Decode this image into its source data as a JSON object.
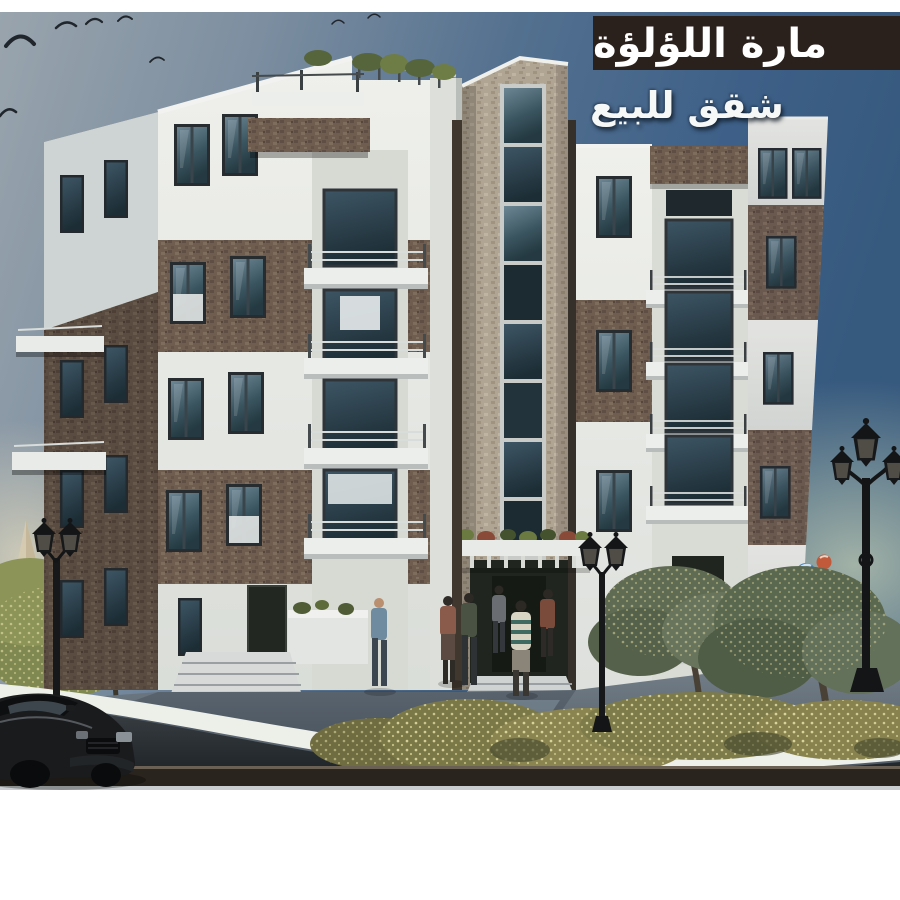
{
  "banner": {
    "title": "مارة اللؤلؤة",
    "bg": "#2b211c",
    "text_color": "#ffffff"
  },
  "caption": {
    "text": "شقق للبيع",
    "text_color": "#f6f8f8"
  },
  "colors": {
    "page_margin": "#ffffff",
    "sky_left": "#99a4ad",
    "sky_right": "#36597e",
    "sky_horizon_glow": "#b5c2ae",
    "building_plaster": "#eff0ec",
    "building_plaster_shade": "#ced4d4",
    "building_stone_dark": "#6f5d50",
    "building_stone_light": "#b0a493",
    "window_glass": "#3a545f",
    "balcony_slab": "#eceeec",
    "pavement": "#66737f",
    "curb": "#edefe9",
    "road": "#2a3034",
    "footer_band": "#2a241f",
    "foliage": "#5f6b52",
    "foliage_accent": "#b8b271",
    "car_body": "#1a1b1d",
    "lamp_iron": "#17181a"
  }
}
